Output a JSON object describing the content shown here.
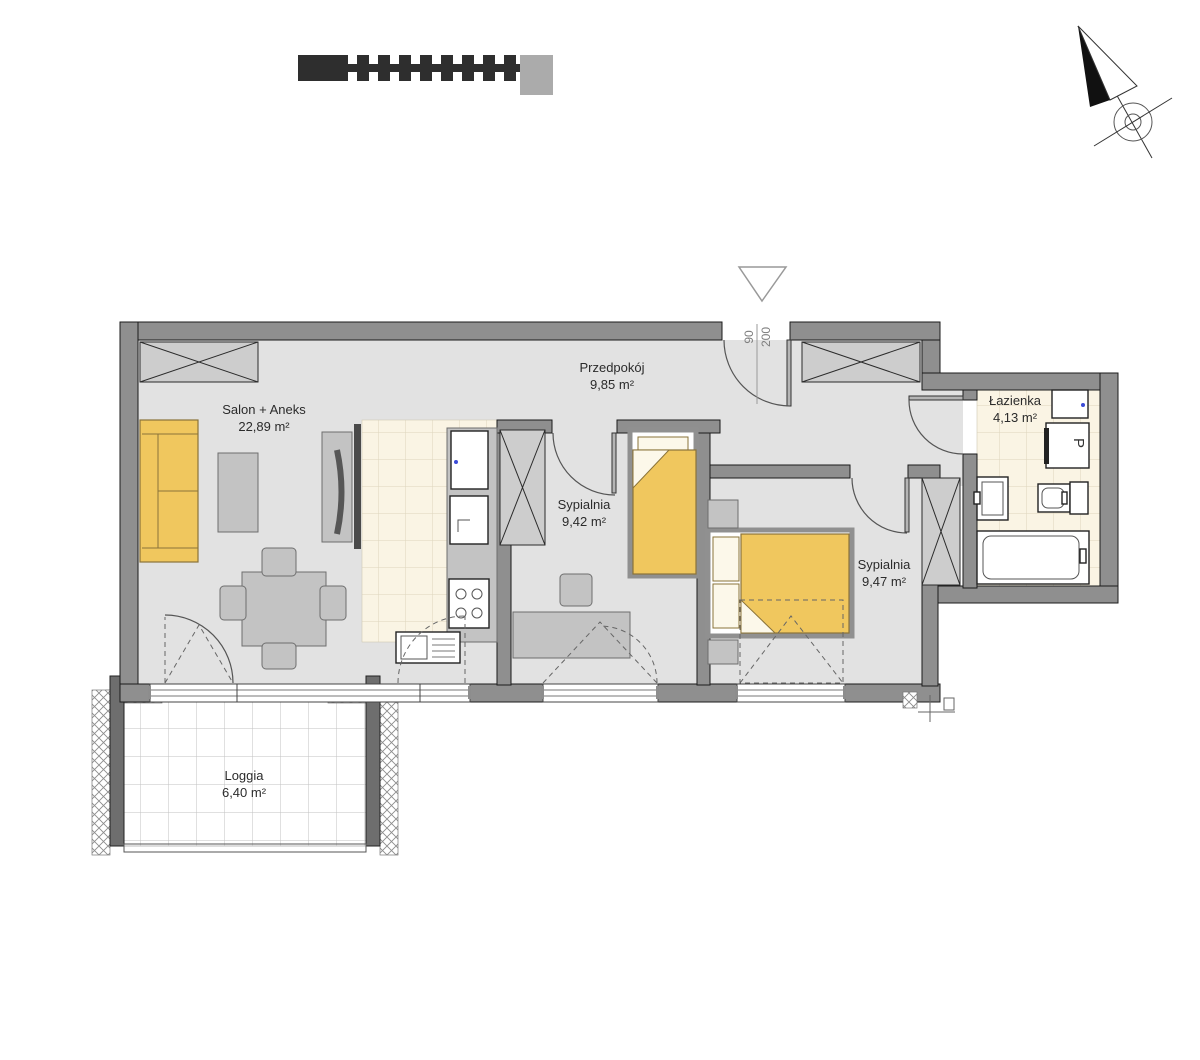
{
  "plan": {
    "rooms": [
      {
        "id": "salon",
        "name": "Salon + Aneks",
        "area": "22,89 m²"
      },
      {
        "id": "przedpokoj",
        "name": "Przedpokój",
        "area": "9,85 m²"
      },
      {
        "id": "sypialnia-1",
        "name": "Sypialnia",
        "area": "9,42 m²"
      },
      {
        "id": "sypialnia-2",
        "name": "Sypialnia",
        "area": "9,47 m²"
      },
      {
        "id": "lazienka",
        "name": "Łazienka",
        "area": "4,13 m²"
      },
      {
        "id": "loggia",
        "name": "Loggia",
        "area": "6,40 m²"
      }
    ],
    "entrance_door": {
      "width": "90",
      "height": "200"
    },
    "washer_glyph": "P",
    "icons": {
      "compass": "north-arrow-icon",
      "entrance": "entrance-triangle-icon"
    },
    "colors": {
      "wall": "#8f8f8f",
      "floor": "#e2e2e2",
      "tile_floor": "#faf4e4",
      "accent_furniture": "#f0c75e",
      "hatch_fill": "#cdcdcd"
    }
  }
}
